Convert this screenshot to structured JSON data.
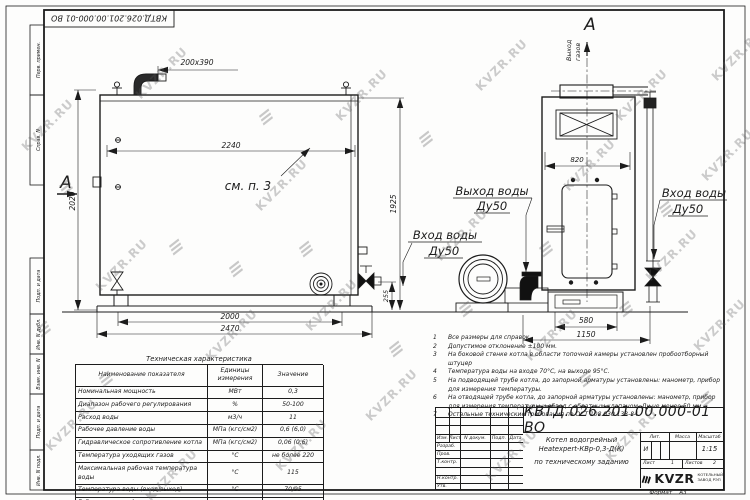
{
  "sheet": {
    "top_stamp": "КВТД.026.201.00.000-01 ВО",
    "format_label": "Формат",
    "format_value": "А3",
    "watermark_text": "KVZR.RU",
    "watermark_mark": "≡",
    "margin_labels": [
      "Перв. примен.",
      "Справ. N",
      "Подп. и дата",
      "Инв. N дубл.",
      "Взам. инв. N",
      "Подп. и дата",
      "Инв. N подл."
    ]
  },
  "views": {
    "side": {
      "section_label": "А",
      "see_note": "см. п. 3",
      "dim_chimney": "200х390",
      "dim_width_top": "2240",
      "dim_height_left": "2020",
      "dim_height_right": "1925",
      "dim_foot": "255",
      "dim_base": "2000",
      "dim_overall": "2470",
      "label_water_in_1": "Вход воды",
      "label_water_in_2": "Ду50"
    },
    "front": {
      "section_label": "А",
      "label_gas_out_line1": "Выход",
      "label_gas_out_line2": "газов",
      "dim_width": "820",
      "dim_base": "580",
      "dim_overall": "1150",
      "label_water_out_1": "Выход воды",
      "label_water_out_2": "Ду50",
      "label_water_in_1": "Вход воды",
      "label_water_in_2": "Ду50"
    }
  },
  "notes": [
    {
      "num": "1",
      "text": "Все размеры для справок"
    },
    {
      "num": "2",
      "text": "Допустимое отклонение ±100 мм."
    },
    {
      "num": "3",
      "text": "На боковой стенке котла в области топочной камеры установлен пробоотборный штуцер"
    },
    {
      "num": "4",
      "text": "Температура воды на входе 70°С, на выходе 95°С."
    },
    {
      "num": "5",
      "text": "На подводящей трубе котла, до запорной арматуры установлены: манометр, прибор для измерения температуры."
    },
    {
      "num": "6",
      "text": "На отводящей трубе котла, до запорной арматуры установлены: манометр, прибор для измерения температуры и обвод с обратным клапаном. Ду не менее 50 мм."
    },
    {
      "num": "7",
      "text": "Остальные технические требования по ОСТ 108.030.133-84."
    }
  ],
  "tech_table": {
    "title": "Техническая характеристика",
    "headers": [
      "Наименование показателя",
      "Единицы измерения",
      "Значение"
    ],
    "rows": [
      {
        "name": "Номинальная мощность",
        "unit": "МВт",
        "value": "0,3"
      },
      {
        "name": "Диапазон рабочего регулирования",
        "unit": "%",
        "value": "50-100"
      },
      {
        "name": "Расход воды",
        "unit": "м3/ч",
        "value": "11"
      },
      {
        "name": "Рабочее давление воды",
        "unit": "МПа (кгс/см2)",
        "value": "0,6 (6,0)"
      },
      {
        "name": "Гидравлическое сопротивление котла",
        "unit": "МПа (кгс/см2)",
        "value": "0,06 (0,6)"
      },
      {
        "name": "Температура уходящих газов",
        "unit": "°С",
        "value": "не более 220"
      },
      {
        "name": "Максимальная рабочая температура воды",
        "unit": "°С",
        "value": "115"
      },
      {
        "name": "Температура воды (вход/выход)",
        "unit": "°С",
        "value": "70/95"
      },
      {
        "name": "Габариты котла (длина х ширина х высота)",
        "unit": "мм",
        "value": "2470х1150х2020"
      }
    ]
  },
  "title_block": {
    "designation": "КВТД.026.201.00.000-01 ВО",
    "doc_name_line1": "Котел водогрейный",
    "doc_name_line2": "Heatexpert-КВр-0,3-Д(К)",
    "doc_name_line3": "по техническому заданию",
    "col_izm": "Изм.",
    "col_list": "Лист",
    "col_doc": "N докум.",
    "col_podp": "Подп.",
    "col_data": "Дата",
    "rows": [
      "Разраб.",
      "Пров.",
      "Т.контр.",
      "",
      "Н.контр.",
      "Утв."
    ],
    "lit_label": "Лит.",
    "mass_label": "Масса",
    "scale_label": "Масштаб",
    "lit_value": "И",
    "scale_value": "1:15",
    "sheet_label": "Лист",
    "sheet_value": "1",
    "sheets_label": "Листов",
    "sheets_value": "2",
    "company_name": "KVZR",
    "company_line1": "КОТЕЛЬНЫЙ",
    "company_line2": "ЗАВОД РЭП"
  }
}
